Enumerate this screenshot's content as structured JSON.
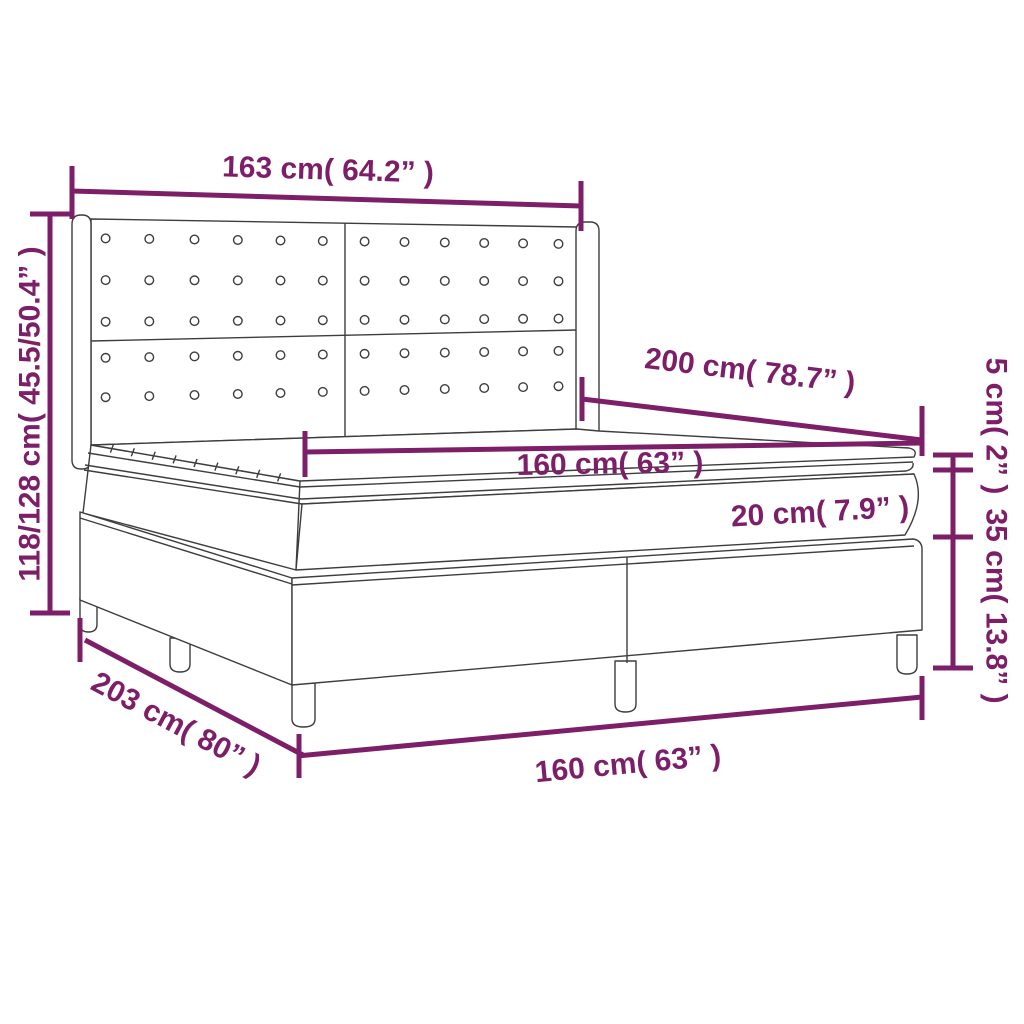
{
  "colors": {
    "dimension_accent": "#7c1f68",
    "drawing_line": "#3d3d3d",
    "background": "#ffffff"
  },
  "diagram": {
    "type": "product-dimension-diagram",
    "subject": "box spring bed with tufted wing headboard, mattress and topper",
    "dimensions": {
      "headboard_width": {
        "label": "163 cm( 64.2” )"
      },
      "headboard_height": {
        "label": "118/128 cm( 45.5/50.4” )"
      },
      "bed_length": {
        "label": "200 cm( 78.7” )"
      },
      "mattress_width": {
        "label": "160 cm( 63” )"
      },
      "mattress_thickness": {
        "label": "20 cm( 7.9” )"
      },
      "topper_thickness": {
        "label": "5 cm( 2” )"
      },
      "base_height": {
        "label": "35 cm( 13.8” )"
      },
      "total_length": {
        "label": "203 cm( 80” )"
      },
      "base_width": {
        "label": "160 cm( 63” )"
      }
    },
    "headboard": {
      "button_rows": 5,
      "button_columns": 12
    }
  }
}
